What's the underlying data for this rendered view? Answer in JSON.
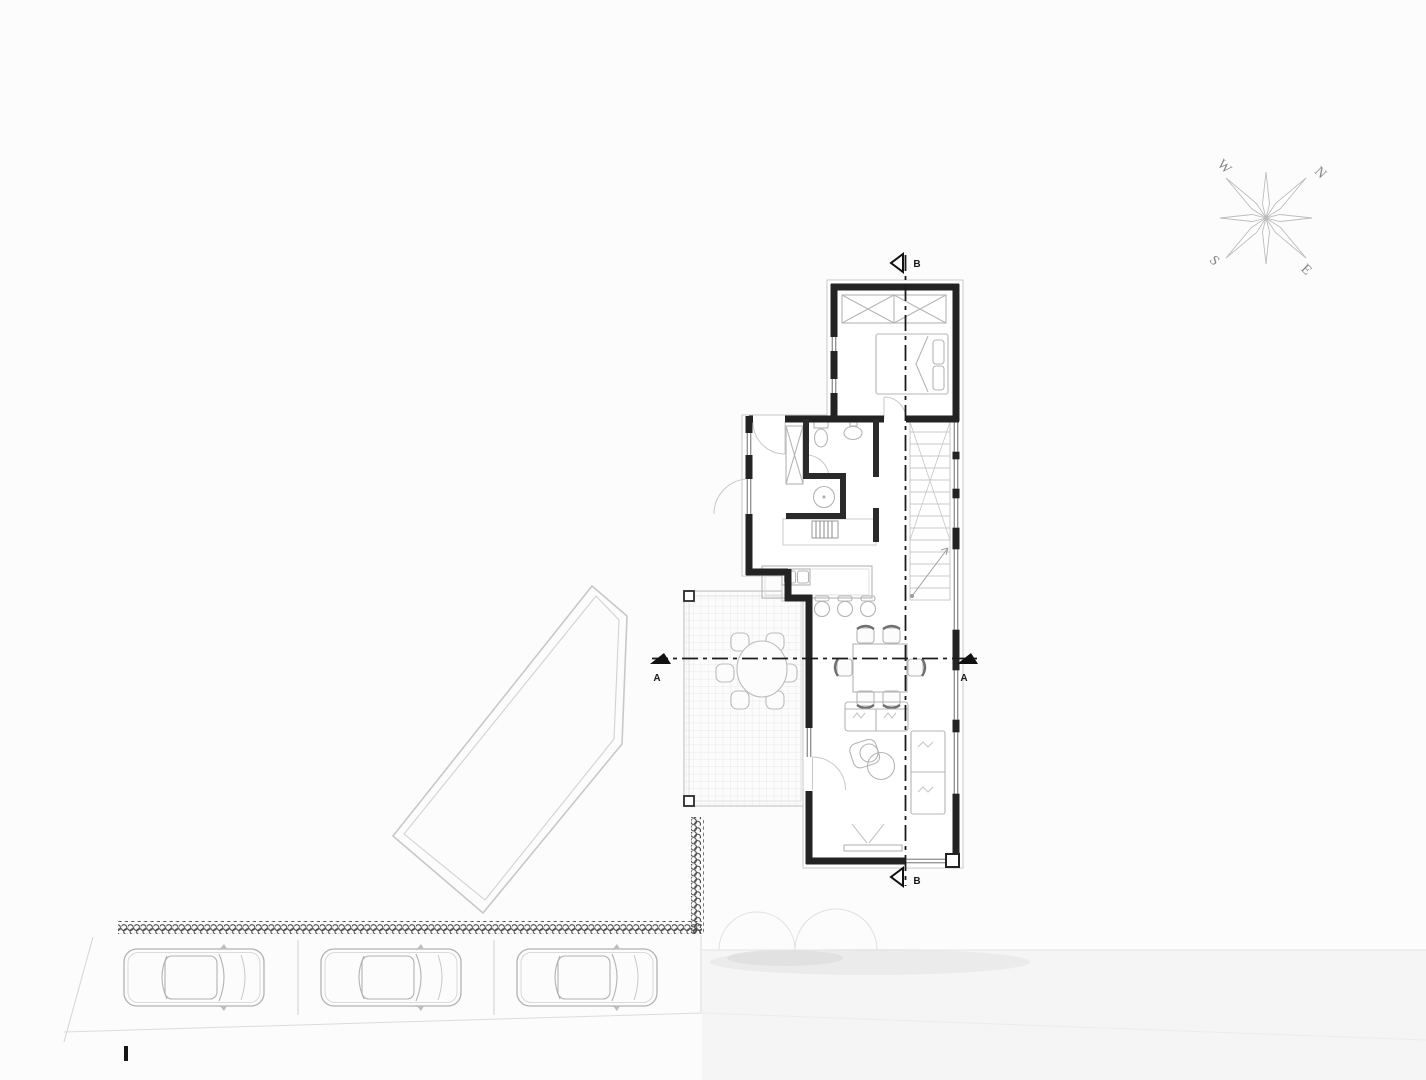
{
  "scene": {
    "kind": "architectural-site-and-floor-plan",
    "background": "#fcfcfc"
  },
  "compass": {
    "north": "N",
    "south": "S",
    "east": "E",
    "west": "W"
  },
  "sections": {
    "a": "A",
    "b": "B"
  },
  "colors": {
    "walls": "#232323",
    "section_lines": "#1c1c1c",
    "furniture_lines": "#b5b5b5",
    "terrace_grid": "#e4e4e4",
    "pool_outline": "#c8c8c8",
    "fence": "#4a4a4a",
    "car_lines": "#b2b2b2",
    "compass_lines": "#c4c4c4",
    "compass_text": "#858585",
    "road_shade": "#f3f3f3"
  }
}
